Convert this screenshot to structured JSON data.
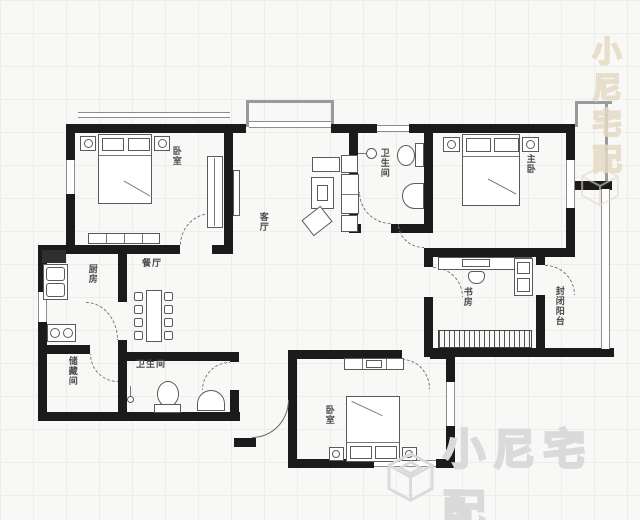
{
  "rooms": {
    "bedroom_top_left": {
      "label": "卧室"
    },
    "living_room": {
      "label": "客厅"
    },
    "bathroom_top": {
      "label": "卫生间"
    },
    "master_bedroom": {
      "label": "主卧"
    },
    "study": {
      "label": "书房"
    },
    "enclosed_balcony": {
      "label": "封闭阳台"
    },
    "kitchen": {
      "label": "厨房"
    },
    "dining_room": {
      "label": "餐厅"
    },
    "storage_room": {
      "label": "储藏间"
    },
    "bathroom_bottom": {
      "label": "卫生间"
    },
    "bedroom_bottom": {
      "label": "卧室"
    }
  },
  "watermarks": {
    "bottom_right": {
      "brand": "小尼宅配",
      "logo": "cube-logo",
      "color": "#dadada"
    },
    "top_right": {
      "brand": "小尼宅配",
      "logo": "cube-logo",
      "color": "#e5dac5"
    }
  },
  "colors": {
    "wall": "#1b1b1b",
    "furniture_line": "#5a5a5a",
    "label_text": "#4a4a4a",
    "grid_line": "#ededec"
  }
}
